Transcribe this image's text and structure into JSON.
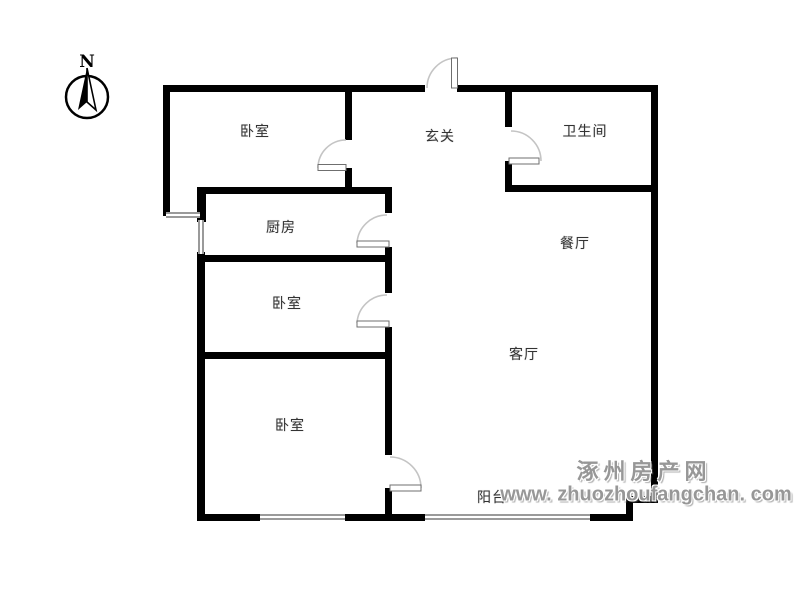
{
  "compass": {
    "north_label": "N"
  },
  "rooms": {
    "bedroom_top": {
      "label": "卧室"
    },
    "hallway": {
      "label": "玄关"
    },
    "bathroom": {
      "label": "卫生间"
    },
    "kitchen": {
      "label": "厨房"
    },
    "dining": {
      "label": "餐厅"
    },
    "bedroom_middle": {
      "label": "卧室"
    },
    "living": {
      "label": "客厅"
    },
    "bedroom_bottom": {
      "label": "卧室"
    },
    "balcony": {
      "label": "阳台"
    }
  },
  "watermark": {
    "site_name": "涿州房产网",
    "site_url": "www. zhuozhoufangchan. com"
  },
  "colors": {
    "background": "#ffffff",
    "wall": "#000000",
    "window_line": "#9a9a9a",
    "door_arc": "#c4c4c4",
    "door_panel_outline": "#6f6f6f",
    "room_label_text": "#333333",
    "watermark_text": "#979797"
  }
}
